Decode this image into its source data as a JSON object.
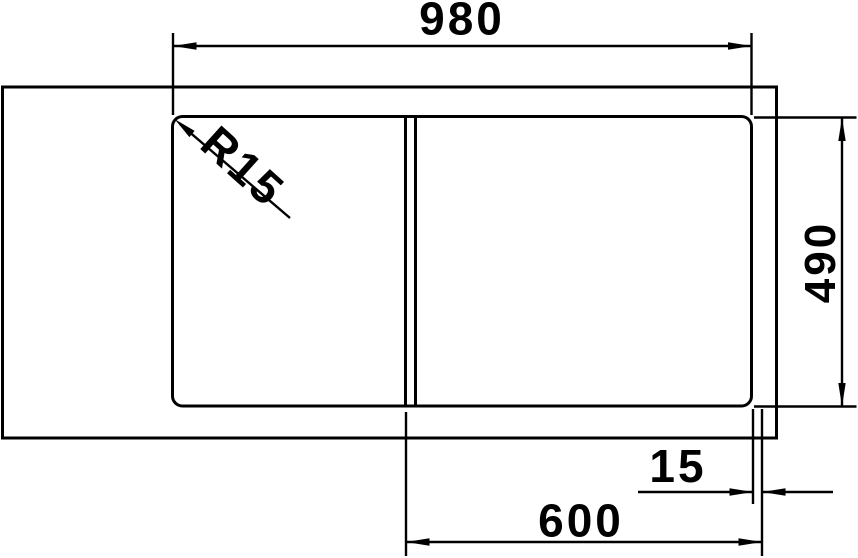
{
  "drawing": {
    "labels": {
      "overall_width": "980",
      "overall_depth": "490",
      "corner_radius": "R15",
      "bowl_width": "600",
      "bowl_edge_offset": "15"
    },
    "colors": {
      "line": "#000000",
      "background": "#ffffff"
    }
  }
}
